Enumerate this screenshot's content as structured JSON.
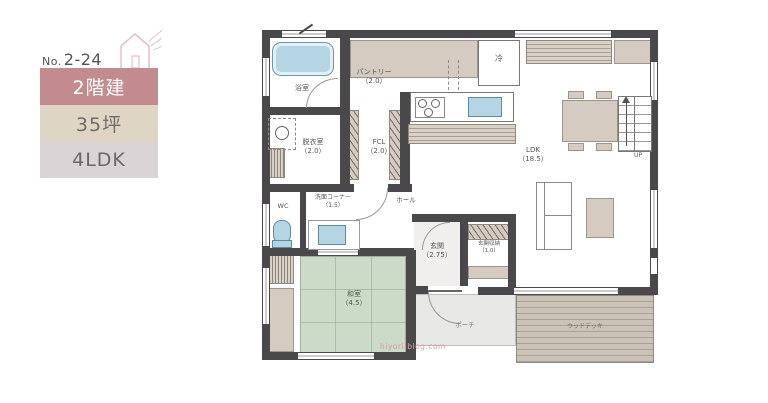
{
  "panel": {
    "no_prefix": "No.",
    "no_value": "2-24",
    "badges": [
      {
        "id": "floors",
        "label": "2階建"
      },
      {
        "id": "area",
        "label": "35坪"
      },
      {
        "id": "layout",
        "label": "4LDK"
      }
    ]
  },
  "plan": {
    "rooms": {
      "bath": {
        "name": "浴室"
      },
      "pantry": {
        "name": "パントリー",
        "size": "（2.0）"
      },
      "dressing": {
        "name": "脱衣室",
        "size": "（2.0）"
      },
      "fcl": {
        "name": "FCL",
        "size": "（2.0）"
      },
      "wc": {
        "name": "WC"
      },
      "wash": {
        "name": "洗面コーナー",
        "size": "（1.5）"
      },
      "hall": {
        "name": "ホール"
      },
      "ldk": {
        "name": "LDK",
        "size": "（18.5）"
      },
      "washitsu": {
        "name": "和室",
        "size": "（4.5）"
      },
      "genkan": {
        "name": "玄関",
        "size": "（2.75）"
      },
      "shoes": {
        "name": "玄関収納",
        "size": "（1.0）"
      },
      "porch": {
        "name": "ポーチ"
      },
      "deck": {
        "name": "ウッドデッキ"
      }
    },
    "fixtures": {
      "fridge": "冷",
      "stairs": "UP"
    },
    "watermark": "hiyori-blog.com"
  },
  "colors": {
    "badge_pink": "#c28b8e",
    "badge_beige": "#ded5c5",
    "badge_gray": "#d9d5d7",
    "wall_dark": "#4a484a",
    "builtin_beige": "#d5cbc0",
    "tatami_green": "#ccdbc7",
    "water_blue": "#b5d5e5",
    "deck_tan": "#cbc3b8",
    "porch_gray": "#e8e8e6",
    "watermark_pink": "#dc9aa2"
  }
}
